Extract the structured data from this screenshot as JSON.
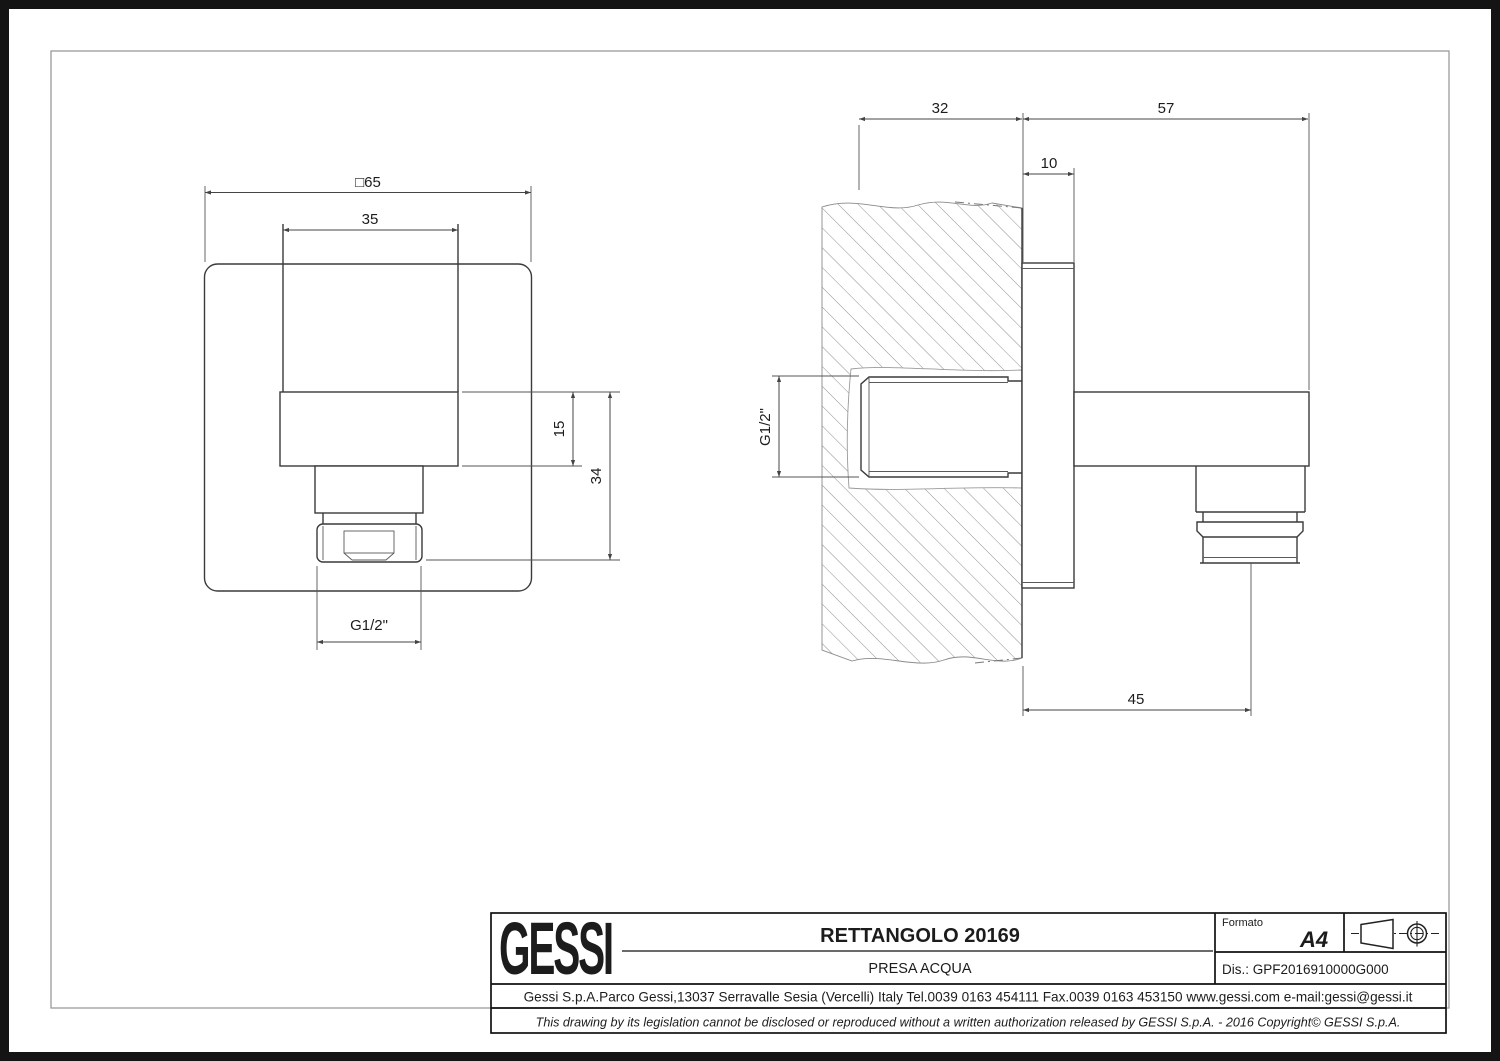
{
  "drawing": {
    "front_view": {
      "dim_plate_width": "□65",
      "dim_body_width": "35",
      "dim_band_height": "15",
      "dim_total_height": "34",
      "dim_thread": "G1/2\""
    },
    "side_view": {
      "dim_wall_depth": "32",
      "dim_projection": "57",
      "dim_plate_thickness": "10",
      "dim_outlet_offset": "45",
      "dim_thread": "G1/2\""
    }
  },
  "title_block": {
    "logo": "GESSI",
    "title": "RETTANGOLO 20169",
    "subtitle": "PRESA ACQUA",
    "format_label": "Formato",
    "format_value": "A4",
    "drawing_number": "Dis.: GPF2016910000G000",
    "address": "Gessi S.p.A.Parco Gessi,13037 Serravalle Sesia (Vercelli) Italy Tel.0039 0163 454111 Fax.0039 0163 453150 www.gessi.com e-mail:gessi@gessi.it",
    "disclaimer": "This drawing by its legislation cannot be disclosed or reproduced without a written authorization released by GESSI S.p.A. - 2016 Copyright© GESSI S.p.A."
  }
}
